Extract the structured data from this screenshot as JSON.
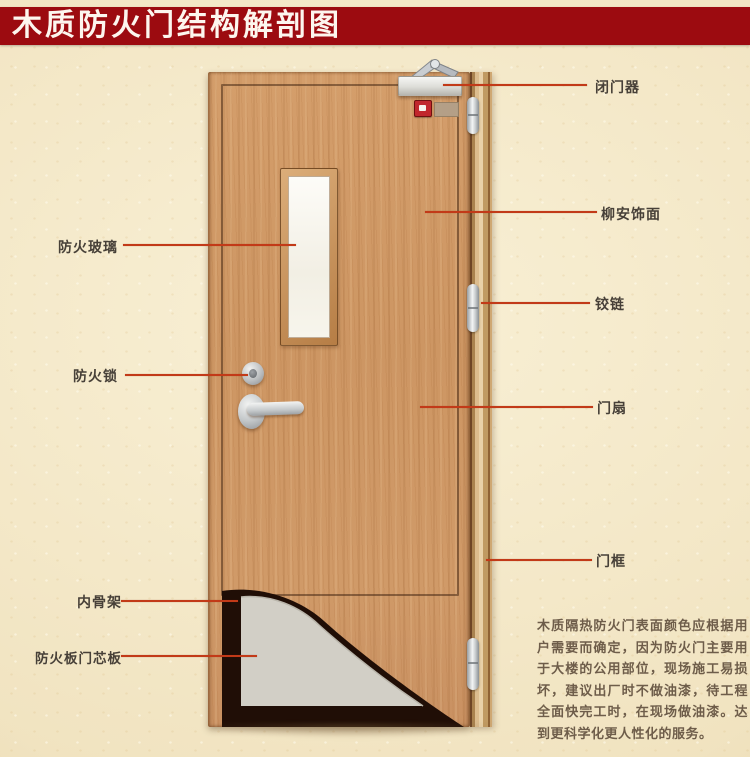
{
  "title": "木质防火门结构解剖图",
  "colors": {
    "banner": "#9c0b10",
    "leader_line": "#c23a18",
    "label_text": "#474038",
    "door_wood": "#d09a68",
    "core_board_gray": "#d2cfc6",
    "inner_skeleton_dark": "#1f0e06",
    "background": "#f1e5c3"
  },
  "labels": {
    "right": [
      {
        "id": "door-closer",
        "text": "闭门器"
      },
      {
        "id": "lauan-veneer",
        "text": "柳安饰面"
      },
      {
        "id": "hinge",
        "text": "铰链"
      },
      {
        "id": "door-leaf",
        "text": "门扇"
      },
      {
        "id": "door-frame",
        "text": "门框"
      }
    ],
    "left": [
      {
        "id": "fire-glass",
        "text": "防火玻璃"
      },
      {
        "id": "fire-lock",
        "text": "防火锁"
      },
      {
        "id": "inner-skeleton",
        "text": "内骨架"
      },
      {
        "id": "fire-board-core",
        "text": "防火板门芯板"
      }
    ]
  },
  "description": "木质隔热防火门表面颜色应根据用户需要而确定，因为防火门主要用于大楼的公用部位，现场施工易损坏，建议出厂时不做油漆，待工程全面快完工时，在现场做油漆。达到更科学化更人性化的服务。"
}
